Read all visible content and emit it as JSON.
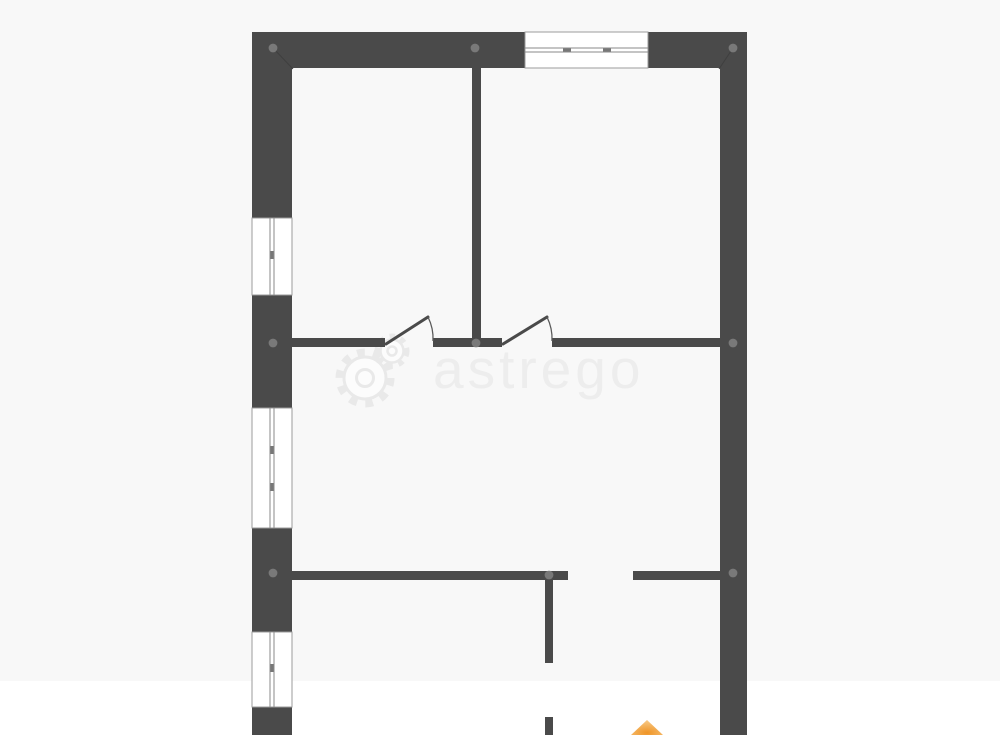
{
  "watermark": {
    "text": "astrego",
    "logo": "gears-icon",
    "text_color": "#ededed",
    "logo_color": "#e9e9e9",
    "logo_fill": "#fcfcfc"
  },
  "floor_plan": {
    "canvas": {
      "w": 1000,
      "h": 735
    },
    "bg_band": {
      "x": 0,
      "y": 0,
      "w": 1000,
      "h": 681,
      "color": "#f8f8f8"
    },
    "colors": {
      "wall": "#4a4a4a",
      "node": "#7d7d7d",
      "window_frame": "#9b9b9b",
      "window_fill": "#ffffff",
      "window_glass": "#8a8a8a",
      "window_tick": "#777777",
      "door_leaf": "#4a4a4a",
      "door_arc": "#5a5a5a",
      "joint": "#a6a6a6",
      "miter": "#3f3f3f",
      "marker_core": "#ef9426",
      "marker_edge": "#f7c57e"
    },
    "walls": [
      {
        "x": 252,
        "y": 32,
        "w": 273,
        "h": 36
      },
      {
        "x": 648,
        "y": 32,
        "w": 99,
        "h": 36
      },
      {
        "x": 252,
        "y": 32,
        "w": 40,
        "h": 186
      },
      {
        "x": 252,
        "y": 295,
        "w": 40,
        "h": 113
      },
      {
        "x": 252,
        "y": 528,
        "w": 40,
        "h": 104
      },
      {
        "x": 252,
        "y": 707,
        "w": 40,
        "h": 28
      },
      {
        "x": 720,
        "y": 32,
        "w": 27,
        "h": 703
      },
      {
        "x": 472,
        "y": 68,
        "w": 9,
        "h": 279
      },
      {
        "x": 292,
        "y": 338,
        "w": 93,
        "h": 9
      },
      {
        "x": 433,
        "y": 338,
        "w": 69,
        "h": 9
      },
      {
        "x": 552,
        "y": 338,
        "w": 168,
        "h": 9
      },
      {
        "x": 292,
        "y": 571,
        "w": 276,
        "h": 9
      },
      {
        "x": 633,
        "y": 571,
        "w": 87,
        "h": 9
      },
      {
        "x": 545,
        "y": 571,
        "w": 8,
        "h": 92
      },
      {
        "x": 545,
        "y": 717,
        "w": 8,
        "h": 18
      }
    ],
    "windows": [
      {
        "x": 525,
        "y": 32,
        "w": 123,
        "h": 36,
        "dir": "h",
        "ticks": [
          567,
          607
        ]
      },
      {
        "x": 252,
        "y": 218,
        "w": 40,
        "h": 77,
        "dir": "v",
        "ticks": [
          255
        ]
      },
      {
        "x": 252,
        "y": 408,
        "w": 40,
        "h": 120,
        "dir": "v",
        "ticks": [
          450,
          487
        ]
      },
      {
        "x": 252,
        "y": 632,
        "w": 40,
        "h": 75,
        "dir": "v",
        "ticks": [
          668
        ]
      }
    ],
    "doors": [
      {
        "leaf": {
          "x1": 386,
          "y1": 344,
          "x2": 428,
          "y2": 317
        },
        "arc": "M 428 317 A 48 48 0 0 1 433 341"
      },
      {
        "leaf": {
          "x1": 503,
          "y1": 344,
          "x2": 547,
          "y2": 317
        },
        "arc": "M 547 317 A 49 49 0 0 1 552 341"
      }
    ],
    "nodes": [
      {
        "x": 273,
        "y": 48
      },
      {
        "x": 475,
        "y": 48
      },
      {
        "x": 733,
        "y": 48
      },
      {
        "x": 273,
        "y": 343
      },
      {
        "x": 476,
        "y": 343
      },
      {
        "x": 733,
        "y": 343
      },
      {
        "x": 273,
        "y": 573
      },
      {
        "x": 549,
        "y": 575
      },
      {
        "x": 733,
        "y": 573
      }
    ],
    "miters": [
      {
        "x1": 273,
        "y1": 48,
        "x2": 293,
        "y2": 69
      },
      {
        "x1": 733,
        "y1": 48,
        "x2": 719,
        "y2": 69
      }
    ],
    "joints": [
      {
        "x1": 252,
        "y1": 343,
        "x2": 292,
        "y2": 343
      },
      {
        "x1": 252,
        "y1": 573,
        "x2": 292,
        "y2": 573
      },
      {
        "x1": 720,
        "y1": 343,
        "x2": 747,
        "y2": 343
      },
      {
        "x1": 720,
        "y1": 573,
        "x2": 747,
        "y2": 573
      }
    ],
    "marker": {
      "name": "orange-marker",
      "points": "631,735 647,720 663,735"
    }
  }
}
